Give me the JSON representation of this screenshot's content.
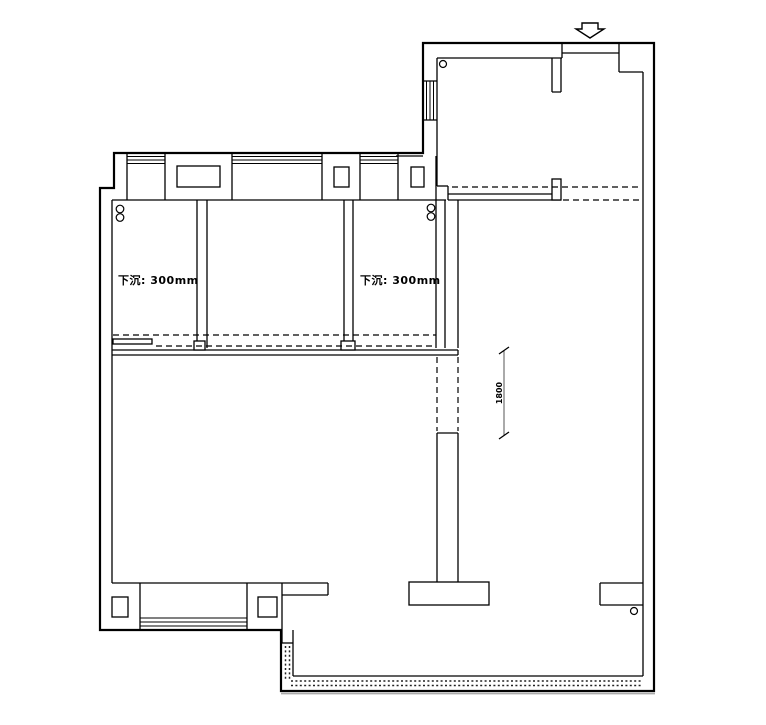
{
  "drawing": {
    "kind": "architectural-floor-plan",
    "background_color": "#ffffff",
    "line_color": "#000000",
    "dimension_line_color": "#555555",
    "balcony_shadow_color": "#aaaaaa"
  },
  "annotations": {
    "sunken_left": "下沉: 300mm",
    "sunken_right": "下沉: 300mm",
    "opening_dimension": "1800"
  },
  "symbols": {
    "entry_arrow": "down-arrow",
    "pipe_markers": "small-circles"
  }
}
